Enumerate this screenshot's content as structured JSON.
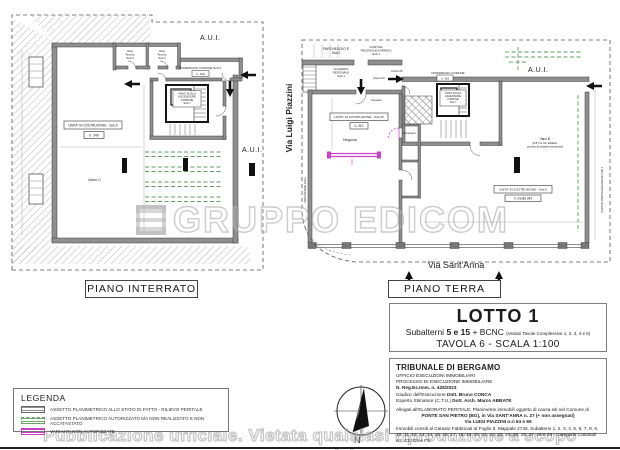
{
  "watermark": {
    "brand": "GRUPPO EDICOM",
    "footer": "Pubblicazione ufficiale. Vietata qualsiasi riproduzione a scopo commerciale"
  },
  "captions": {
    "basement": "PIANO INTERRATO",
    "ground": "PIANO TERRA"
  },
  "streets": {
    "west": "Via Luigi Piazzini",
    "south": "Via Sant'Anna"
  },
  "lotto": {
    "title": "LOTTO 1",
    "sub_prefix": "Subalterni",
    "sub_bold": "5 e 15",
    "sub_plus": "+ BCNC",
    "sub_note": "(Vedasi Tavole Complessive 1, 2, 3, 4 e 5)",
    "tavola": "TAVOLA 6 - SCALA 1:100"
  },
  "tribunale": {
    "court": "TRIBUNALE DI BERGAMO",
    "office": "UFFICIO ESECUZIONI IMMOBILIARI",
    "process": "PROCESSO DI ESECUZIONE IMMOBILIARE",
    "register": "N. Reg.Es.Imm. n. 428/2023",
    "judge_label": "Giudice dell'Esecuzione ",
    "judge_name": "Dott. Bruno CONCA",
    "expert_label": "Esperto Stimatore (C.T.U.) ",
    "expert_name": "Dott. Arch. Marco ABBATE",
    "attachments": "Allegati all'ELABORATO PERITALE: Planimetrie immobili oggetto di causa siti nel Comune di",
    "address1": "PONTE SAN PIETRO (BG), in Via SANT'ANNA n. 27 (+ non assegnati)",
    "address2": "Via LUIGI PIAZZINI n.ri 63 e 65",
    "cadastre": "Immobili censiti al Catasto Fabbricati al Foglio 9, Mappale 2745, Subalterni 1, 2, 3, 4, 5, 6, 7, 8, 9, 10, 11, 12, 13, 14, 15, 16, 17, 18, 19, 20, 21, 22, 23, 24, 25, 26, 27, 28 e 29 - Categorie Catastali A2, C2, C6 e F3."
  },
  "legend": {
    "title": "LEGENDA",
    "items": [
      {
        "label": "ASSETTO PLANIMETRICO ALLO STATO DI FATTO - RILIEVO PERITALE"
      },
      {
        "label": "ASSETTO PLANIMETRICO AUTORIZZATO MA NON REALIZZATO E NON ACCATASTATO"
      },
      {
        "label": "VARIANTI NON AUTORIZZATE"
      }
    ]
  },
  "compass": {
    "north": "N"
  },
  "basement": {
    "aui_top": "A.U.I.",
    "aui_side": "A.U.I.",
    "unit_label": "UNITA' IN COSTRUZIONE - Sub.5",
    "unit_height": "h. 240",
    "corridor_label": "DISIMPEGNO COMUNE Sub.6",
    "corridor_height": "h. 240",
    "stair_l1": "VANO SCALA",
    "stair_l2": "ASCENSORE",
    "stair_l3": "COMUNE",
    "stair_l4": "Sub.7",
    "vano_c": "Vano C",
    "tech1_l1": "Vano",
    "tech1_l2": "Tecnico",
    "tech1_l3": "Sub.3",
    "tech2_l1": "Vano",
    "tech2_l2": "Tecnico",
    "tech2_l3": "Sub.4"
  },
  "ground": {
    "parcheggio_l1": "PARCHEGGIO E",
    "parcheggio_l2": "Sub.2",
    "cortile_l1": "CORTILE",
    "cortile_l2": "PEDONALE/CARRAIO",
    "cortile_l3": "Sub.1",
    "accesso_l1": "ACCESSO",
    "accesso_l2": "PEDONALE",
    "accesso_l3": "Sub.1",
    "civico63": "Civico 63",
    "civico65": "Civico 65",
    "ingresso": "Ingresso",
    "disimpegno_label": "DISIMPEGNO COMUNE",
    "disimpegno_height": "h. 310",
    "stair_l1": "VANO SCALA",
    "stair_l2": "ASCENSORE",
    "stair_l3": "COMUNE",
    "stair_l4": "Sub.7",
    "aui": "A.U.I.",
    "unit15_label": "UNITA' IN COSTRUZIONE - Sub.15",
    "unit15_height": "h. 310",
    "negozio": "Negozio",
    "disimpegno_small": "Disimpegno",
    "unit5_label": "UNITA' IN COSTRUZIONE - Sub.5",
    "unit5_height": "h. media 342",
    "vanob_l1": "Vano B",
    "vanob_l2": "(N.B. h/2 non abitabile,",
    "vanob_l3": "previsto da progetto autorizzato)",
    "marciapiede": "MARCIAPIEDE Sub.2",
    "cortile_right": "CORTILE PEDONALE/CARRAIO Sub.1"
  },
  "colors": {
    "wall_gray": "#8f8f8f",
    "authorized_green": "#5f9e5f",
    "variant_magenta": "#c543c5",
    "watermark_gray": "#b5b5b5"
  }
}
